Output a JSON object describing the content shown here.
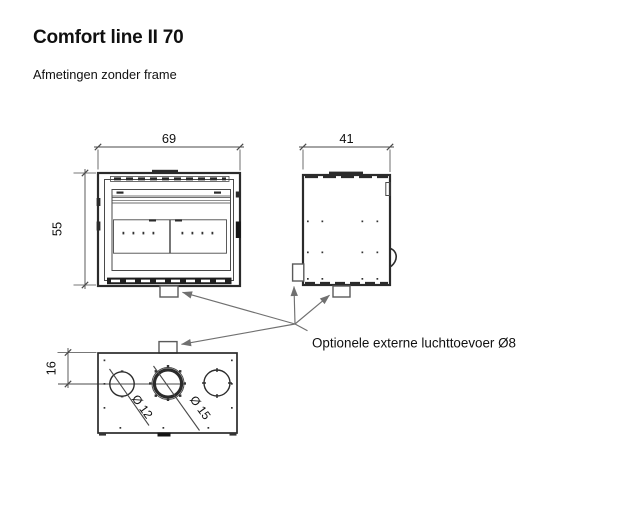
{
  "colors": {
    "bg": "#ffffff",
    "line": "#2b2b2b",
    "thin": "#4a4a4a",
    "leader": "#707070",
    "text": "#101010"
  },
  "header": {
    "title": "Comfort line II 70",
    "subtitle": "Afmetingen zonder frame"
  },
  "drawing": {
    "front_view": {
      "width_label": "69",
      "height_label": "55"
    },
    "side_view": {
      "depth_label": "41"
    },
    "bottom_view": {
      "offset_label": "16",
      "hole_left_label": "Ø 12",
      "hole_center_label": "Ø 15"
    },
    "annotation": {
      "label": "Optionele externe luchttoevoer Ø8"
    }
  }
}
